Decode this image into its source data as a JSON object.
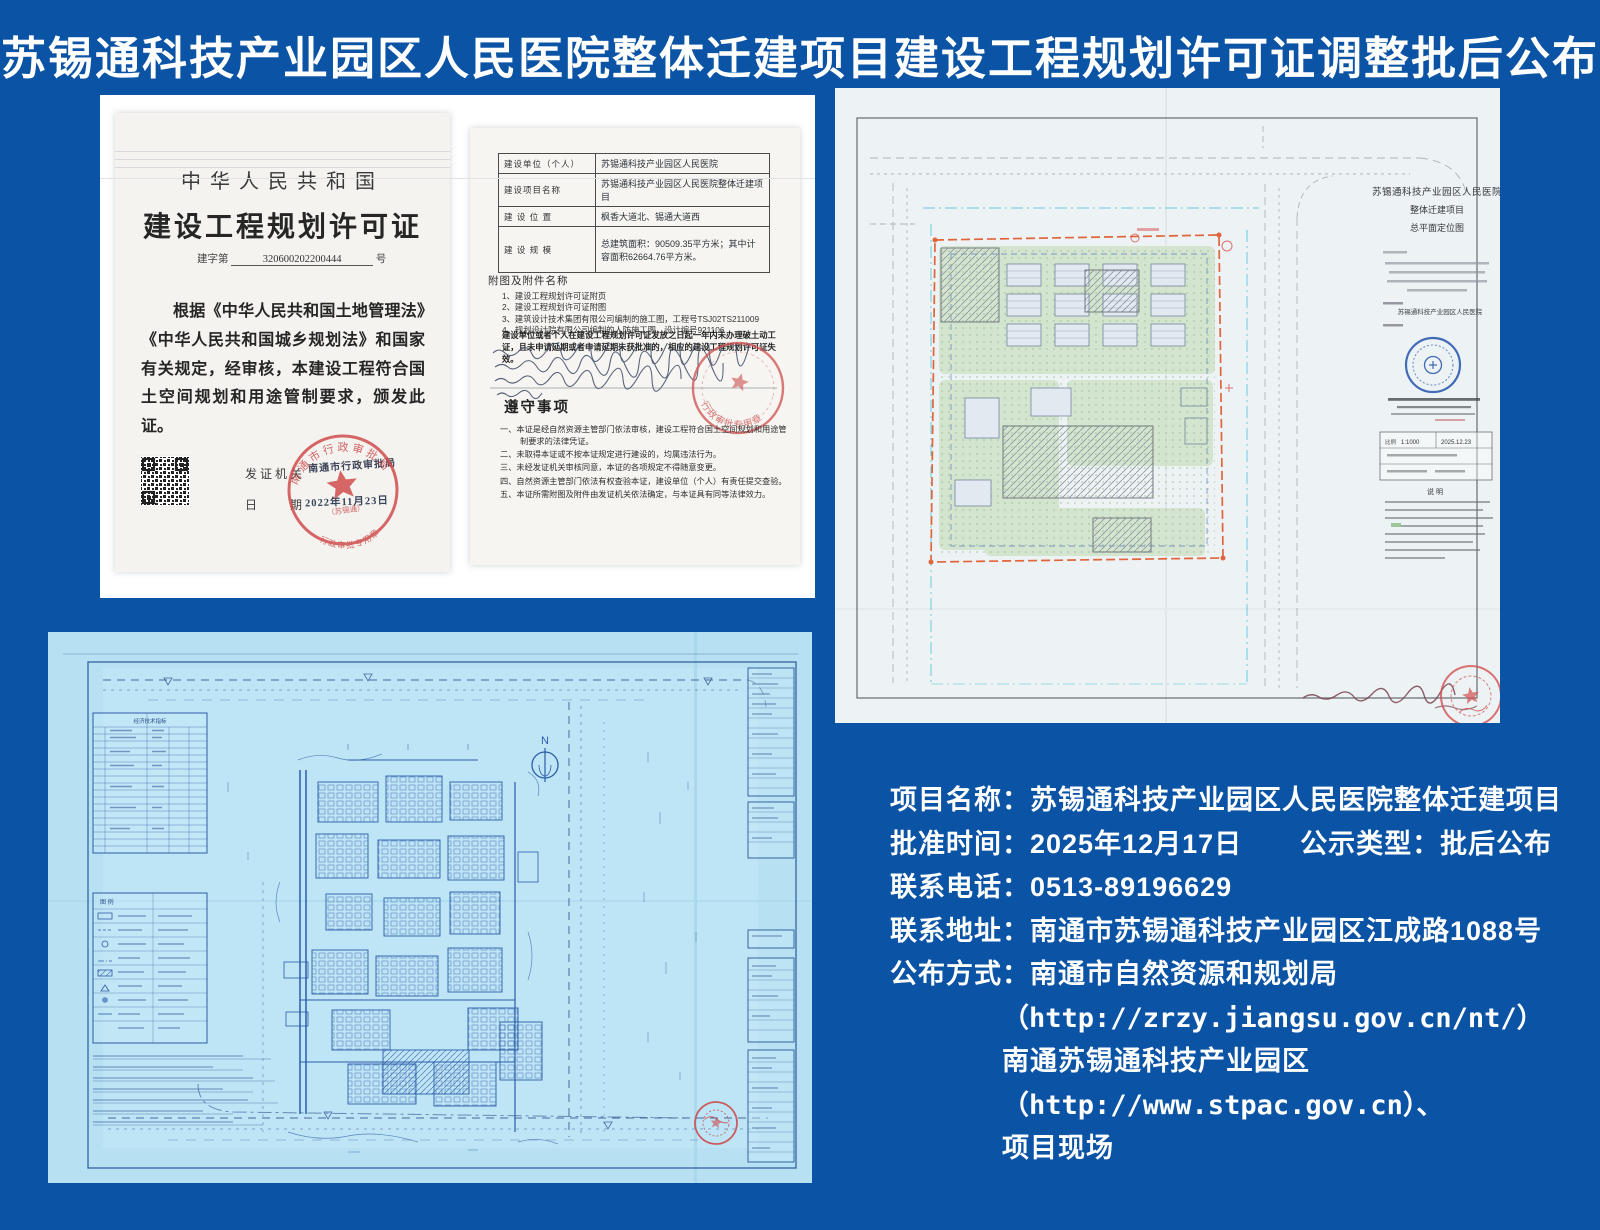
{
  "page": {
    "title": "苏锡通科技产业园区人民医院整体迁建项目建设工程规划许可证调整批后公布"
  },
  "cert_cover": {
    "nation": "中华人民共和国",
    "doc_title": "建设工程规划许可证",
    "no_prefix": "建字第",
    "no_value": "320600202200444",
    "no_suffix": "号",
    "body_text": "根据《中华人民共和国土地管理法》《中华人民共和国城乡规划法》和国家有关规定，经审核，本建设工程符合国土空间规划和用途管制要求，颁发此证。",
    "issuer_label": "发证机关",
    "issuer_value": "南通市行政审批局",
    "date_label": "日　　期",
    "date_value": "2022年11月23日",
    "seal_top": "南通市行政审批局",
    "seal_bottom": "行政审批专用章",
    "seal_sub": "（苏锡通）"
  },
  "cert_detail": {
    "rows": [
      {
        "label": "建设单位（个人）",
        "value": "苏锡通科技产业园区人民医院"
      },
      {
        "label": "建设项目名称",
        "value": "苏锡通科技产业园区人民医院整体迁建项目"
      },
      {
        "label": "建 设 位 置",
        "value": "枫香大道北、锡通大道西"
      },
      {
        "label": "建 设 规 模",
        "value": "总建筑面积：90509.35平方米；其中计容面积62664.76平方米。"
      }
    ],
    "attachments_title": "附图及附件名称",
    "attachments": [
      "1、建设工程规划许可证附页",
      "2、建设工程规划许可证附图",
      "3、建筑设计技术集团有限公司编制的施工图，工程号TSJ02TS211009",
      "4、规划设计院有限公司编制的人防施工图，设计编号921106"
    ],
    "expiry_note": "建设单位或者个人在建设工程规划许可证发放之日起一年内未办理破土动工证，且未申请延期或者申请延期未获批准的，相应的建设工程规划许可证失效。",
    "rules_title": "遵守事项",
    "rules": [
      "一、本证是经自然资源主管部门依法审核，建设工程符合国土空间规划和用途管制要求的法律凭证。",
      "二、未取得本证或不按本证规定进行建设的，均属违法行为。",
      "三、未经发证机关审核同意，本证的各项规定不得随意变更。",
      "四、自然资源主管部门依法有权查验本证，建设单位（个人）有责任提交查验。",
      "五、本证所需附图及附件由发证机关依法确定，与本证具有同等法律效力。"
    ],
    "seal_text": "行政审批专用章"
  },
  "siteplan": {
    "title_line1": "苏锡通科技产业园区人民医院",
    "title_line2": "整体迁建项目",
    "title_line3": "总平面定位图",
    "unit_value": "苏锡通科技产业园区人民医院",
    "scale_label": "比例",
    "scale_value": "1:1000",
    "date_value": "2025.12.23",
    "notes_title": "说 明"
  },
  "blueprint": {
    "econ_title": "经济技术指标",
    "legend_title": "图 例",
    "north_label": "N"
  },
  "info": {
    "rows": [
      {
        "label": "项目名称：",
        "value": "苏锡通科技产业园区人民医院整体迁建项目"
      },
      {
        "label": "批准时间：",
        "value": "2025年12月17日",
        "label2": "公示类型：",
        "value2": "批后公布"
      },
      {
        "label": "联系电话：",
        "value": "0513-89196629"
      },
      {
        "label": "联系地址：",
        "value": "南通市苏锡通科技产业园区江成路1088号"
      },
      {
        "label": "公布方式：",
        "value": "南通市自然资源和规划局"
      },
      {
        "value": "（http://zrzy.jiangsu.gov.cn/nt/）"
      },
      {
        "value": "南通苏锡通科技产业园区"
      },
      {
        "value": "（http://www.stpac.gov.cn）、"
      },
      {
        "value": "项目现场"
      }
    ]
  }
}
